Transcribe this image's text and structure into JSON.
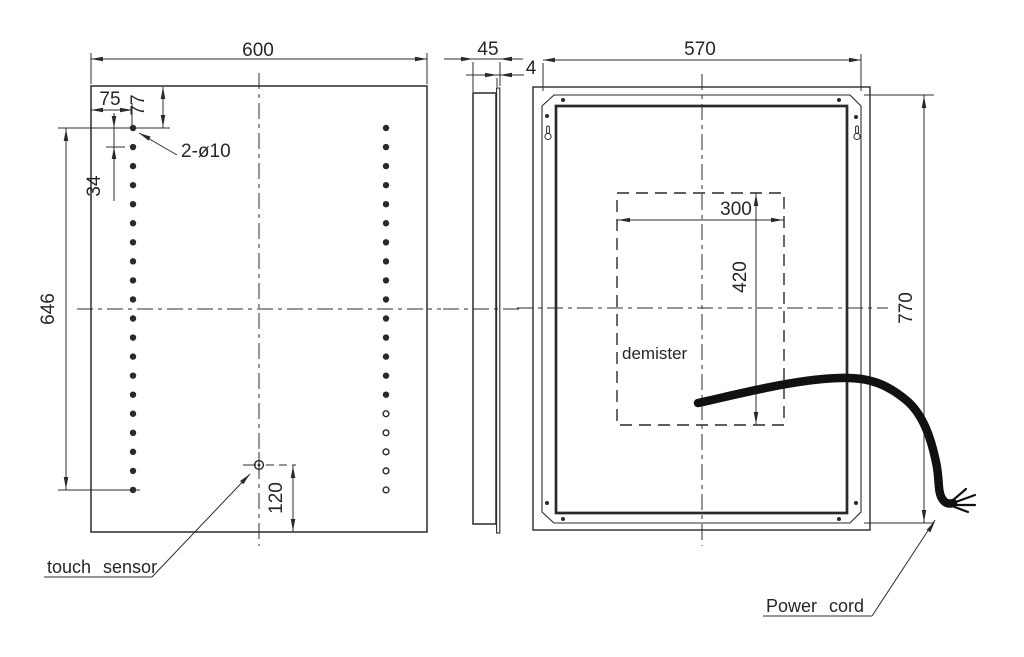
{
  "front_view": {
    "overall_width": "600",
    "hole_offset_left": "75",
    "hole_offset_top": "77",
    "hole_pitch": "34",
    "hole_span_height": "646",
    "holes_callout": "2-ø10",
    "sensor_offset_bottom": "120",
    "sensor_callout": "touch sensor"
  },
  "side_view": {
    "depth": "45",
    "glass_thickness": "4"
  },
  "back_view": {
    "width": "570",
    "height": "770",
    "demister_width": "300",
    "demister_height": "420",
    "demister_label": "demister",
    "power_cord_callout": "Power cord"
  },
  "colors": {
    "line": "#2a2a2a",
    "background": "#ffffff"
  }
}
